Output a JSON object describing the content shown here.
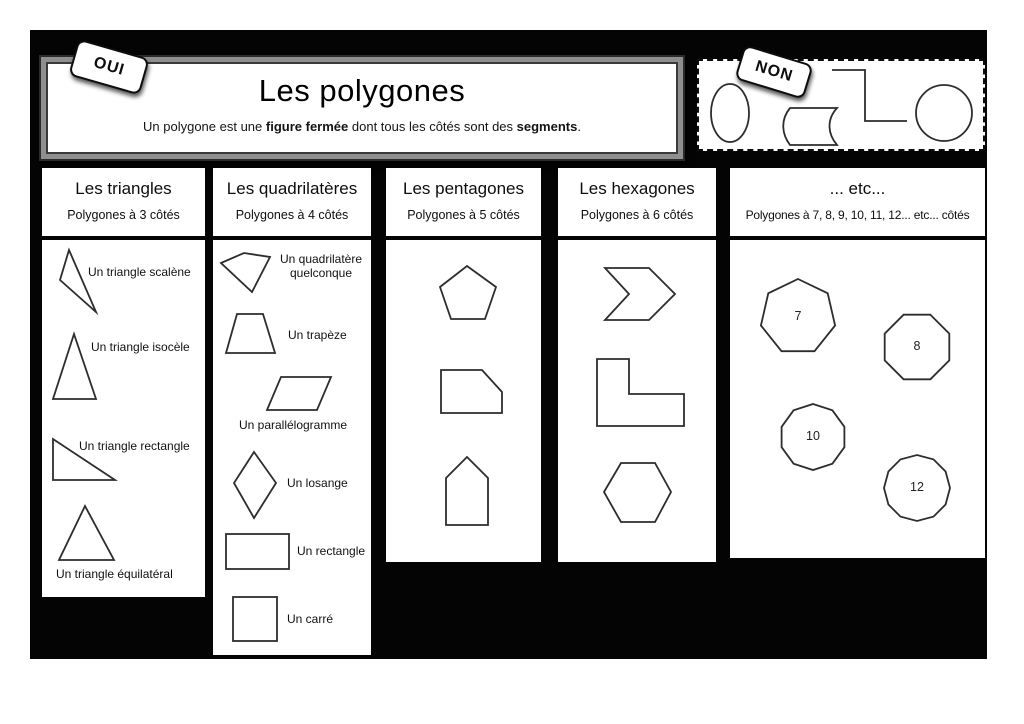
{
  "poster": {
    "oui_tag": "OUI",
    "non_tag": "NON",
    "title": "Les polygones",
    "subtitle": {
      "s1": "Un polygone est une ",
      "b1": "figure fermée",
      "s2": " dont tous les côtés sont des ",
      "b2": "segments",
      "s3": "."
    }
  },
  "columns": {
    "triangles": {
      "title": "Les triangles",
      "subtitle": "Polygones à 3 côtés",
      "shapes": {
        "scalene": "Un triangle scalène",
        "isoceles": "Un triangle isocèle",
        "right": "Un triangle rectangle",
        "equilateral": "Un triangle équilatéral"
      }
    },
    "quadrilaterals": {
      "title": "Les quadrilatères",
      "subtitle": "Polygones à 4 côtés",
      "shapes": {
        "any_line1": "Un quadrilatère",
        "any_line2": "quelconque",
        "trapezoid": "Un trapèze",
        "parallelogram": "Un parallélogramme",
        "rhombus": "Un losange",
        "rectangle": "Un rectangle",
        "square": "Un carré"
      }
    },
    "pentagons": {
      "title": "Les pentagones",
      "subtitle": "Polygones à 5 côtés"
    },
    "hexagons": {
      "title": "Les hexagones",
      "subtitle": "Polygones à 6 côtés"
    },
    "etc": {
      "title": "... etc...",
      "subtitle": "Polygones à 7, 8, 9, 10, 11, 12... etc... côtés",
      "numbers": {
        "heptagon": "7",
        "octagon": "8",
        "decagon": "10",
        "dodecagon": "12"
      }
    }
  }
}
